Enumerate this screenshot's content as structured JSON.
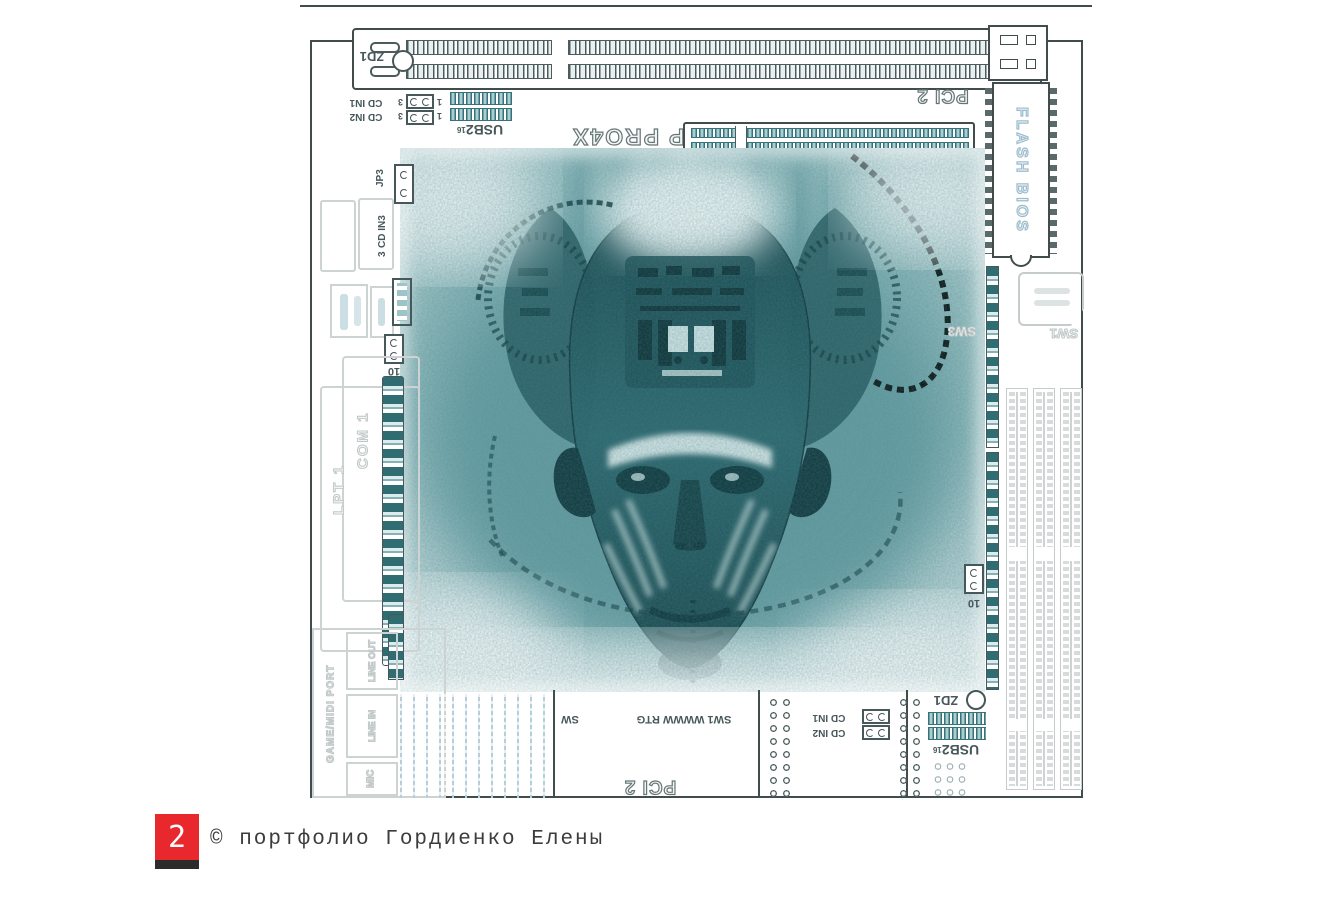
{
  "footer": {
    "page_number": "2",
    "copyright": "© портфолио Гордиенко Елены"
  },
  "board_labels": {
    "zd1": "ZD1",
    "pci2": "PCI 2",
    "cd_in1": "CD IN1",
    "cd_in2": "CD IN2",
    "cd_in3": "CD IN3",
    "pin1": "1",
    "pin3": "3",
    "usb2": "USB2",
    "usb2_pins": "16",
    "agp": "AGP PRO4X",
    "flash_bios": "FLASH BIOS",
    "jp3": "JP3",
    "jumper_10": "10",
    "com1": "COM 1",
    "lpt1": "LPT 1",
    "game_midi_port": "GAME/MIDI PORT",
    "line_out": "LINE OUT",
    "line_in": "LINE IN",
    "mic": "MIC",
    "sw1": "SW1",
    "sw3": "SW3",
    "sw1_rtg": "SW1 WWWW RTG",
    "sw_partial": "SW"
  },
  "palette": {
    "accent_red": "#e8282d",
    "teal": "#2f6d72",
    "board_line": "#414c4c",
    "ghost_gray": "#cdd2d2",
    "art_dark": "#123d42"
  }
}
